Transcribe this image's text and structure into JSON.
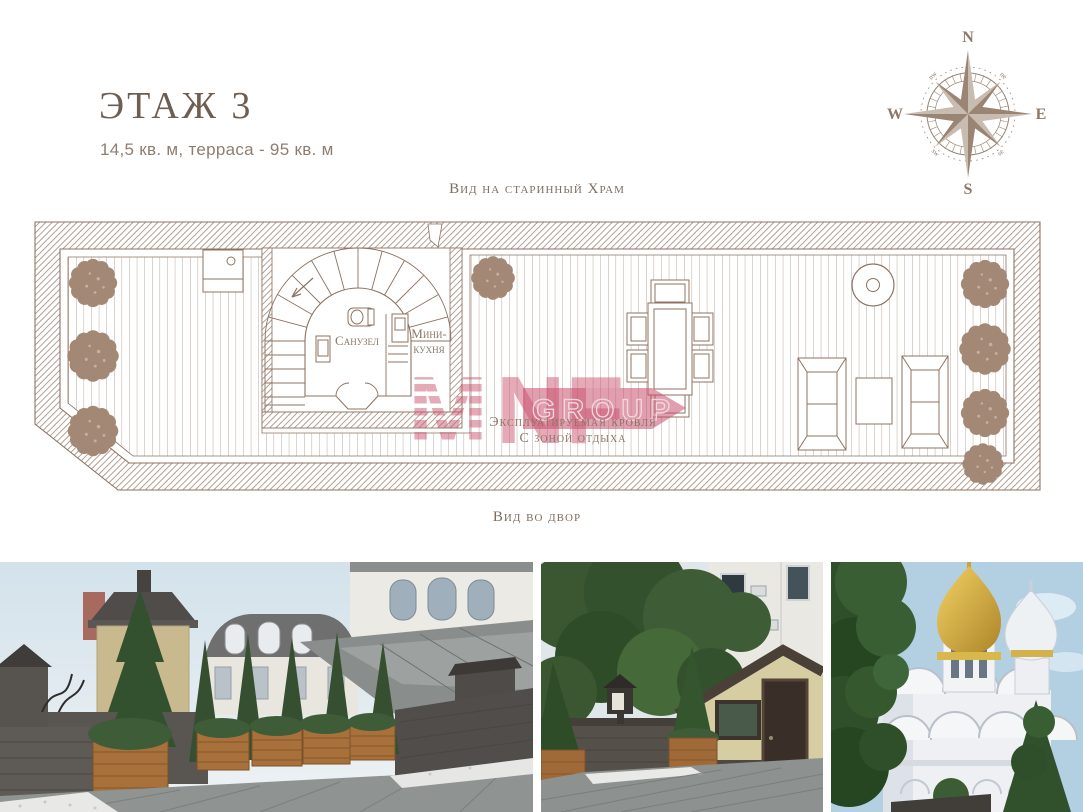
{
  "page": {
    "title": "ЭТАЖ 3",
    "subtitle": "14,5 кв. м, терраса - 95 кв. м"
  },
  "compass": {
    "north": "N",
    "east": "E",
    "south": "S",
    "west": "W",
    "northwest": "nw",
    "northeast": "ne",
    "southwest": "sw",
    "southeast": "se"
  },
  "plan": {
    "view_label_top": "Вид на старинный Храм",
    "view_label_bottom": "Вид во двор",
    "bathroom_label": "Санузел",
    "mini_kitchen_line1": "Мини-",
    "mini_kitchen_line2": "кухня",
    "terrace_label_line1": "Эксплуатируемая кровля",
    "terrace_label_line2": "С зоной отдыха",
    "watermark_m": "M",
    "watermark_nf": "NF",
    "watermark_group": "GROUP"
  },
  "colors": {
    "title_brown": "#6e5e52",
    "subtitle_brown": "#8d7e71",
    "plan_line": "#8f7261",
    "wall_hatch": "#a1887a",
    "shrub_brown": "#a28875",
    "watermark_red": "#cc5572",
    "compass_brown": "#9a8574"
  },
  "photos": [
    {
      "name": "terrace-planters-city-view"
    },
    {
      "name": "terrace-courtyard-entrance"
    },
    {
      "name": "old-church-view"
    }
  ]
}
